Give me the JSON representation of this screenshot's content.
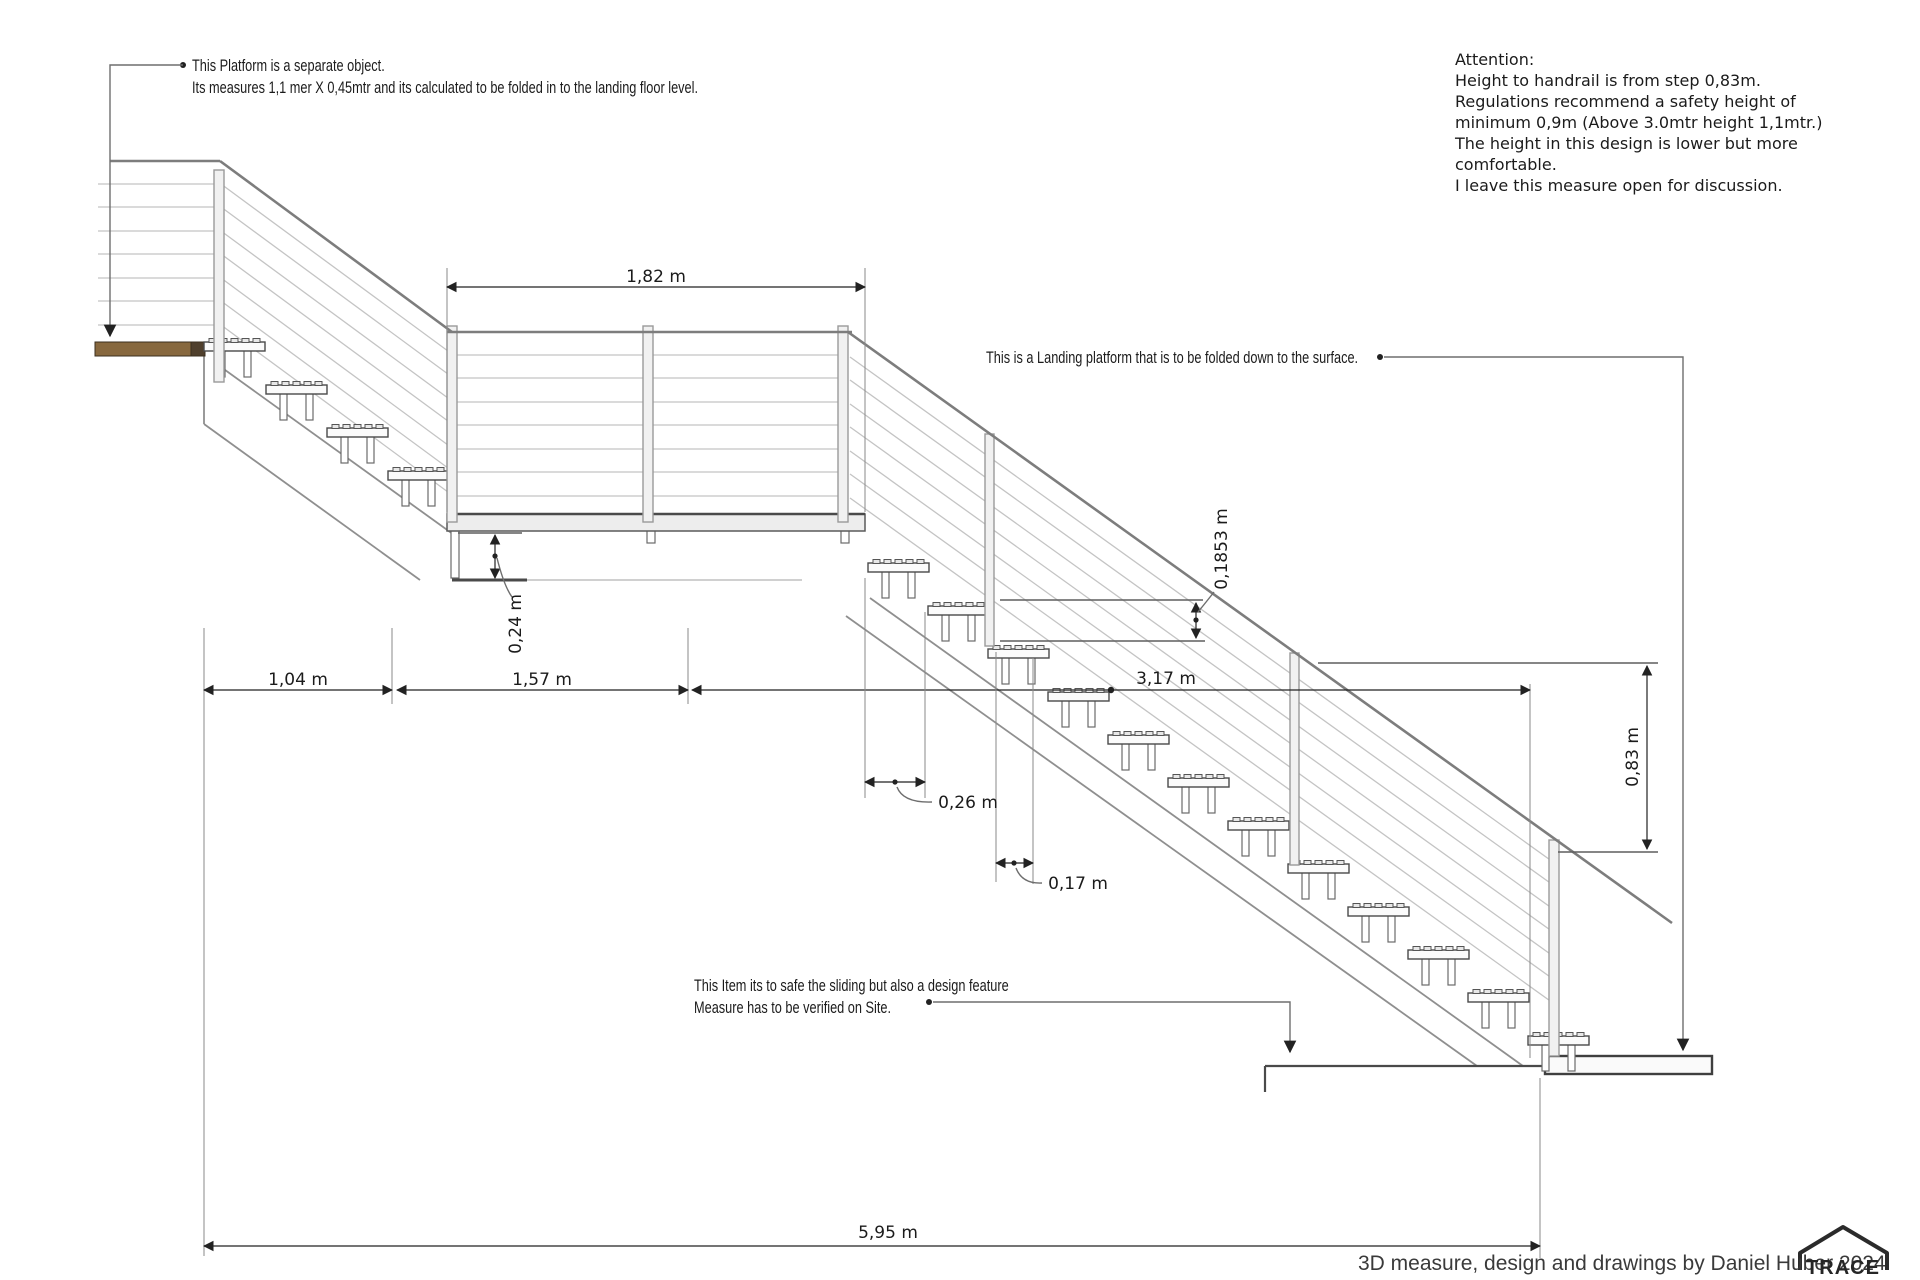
{
  "annotations": {
    "platform_note": {
      "line1": "This Platform is a separate object.",
      "line2": "Its measures 1,1 mer X 0,45mtr and its calculated to be folded in to the landing floor level."
    },
    "attention": [
      "Attention:",
      "Height to handrail is from step 0,83m.",
      "Regulations recommend a safety height of",
      "minimum 0,9m (Above 3.0mtr height 1,1mtr.)",
      "The height in this design is lower but more",
      "comfortable.",
      "I leave this measure open for discussion."
    ],
    "landing_note": "This is a Landing platform that is to be folded down to the surface.",
    "sliding_note": {
      "line1": "This Item its to safe the sliding but also a design feature",
      "line2": "Measure has to be verified on Site."
    }
  },
  "dimensions": {
    "landing_width": "1,82 m",
    "upper_run": "1,04 m",
    "mid_run": "1,57 m",
    "lower_run": "3,17 m",
    "total_run": "5,95 m",
    "gap_under_landing": "0,24 m",
    "tread_depth": "0,26 m",
    "nose_offset": "0,17 m",
    "riser_height": "0,1853 m",
    "handrail_height": "0,83 m"
  },
  "footer": {
    "credit": "3D measure, design and drawings by Daniel Huber 2024",
    "logo": "TRACE"
  },
  "colors": {
    "wood_platform": "#87683e",
    "line_dark": "#4a4a4a",
    "cable_gray": "#c4c4c4",
    "dimension": "#222222"
  }
}
